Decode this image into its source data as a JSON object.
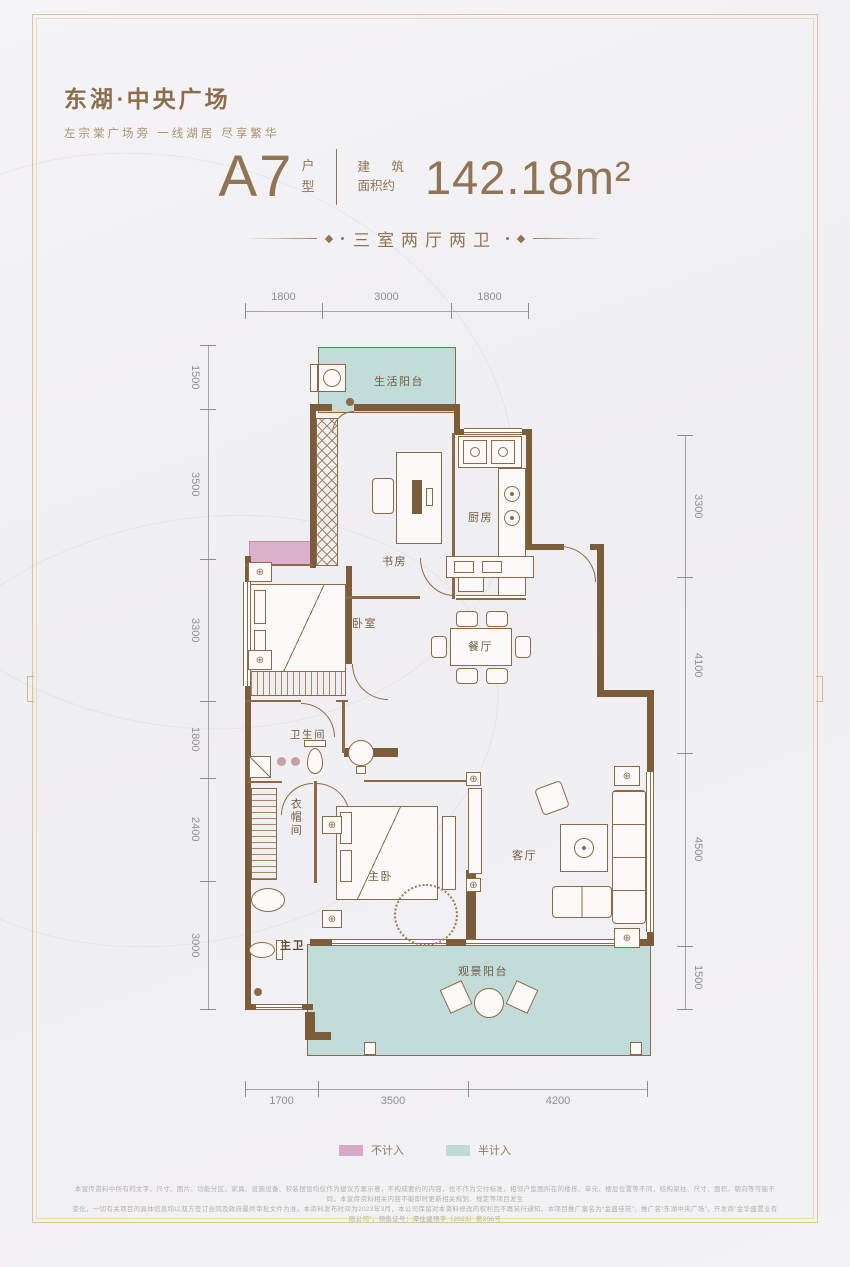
{
  "brand": {
    "logo": "东湖·中央广场",
    "tagline": "左宗棠广场旁 一线湖居 尽享繁华"
  },
  "unit": {
    "name": "A7",
    "type_label": "户型",
    "area_label_line1": "建 筑",
    "area_label_line2": "面积约",
    "area_value": "142.18m²",
    "layout": "三室两厅两卫"
  },
  "plan": {
    "rooms": {
      "service_balcony": "生活阳台",
      "study": "书房",
      "kitchen": "厨房",
      "bedroom": "卧室",
      "dining": "餐厅",
      "bathroom": "卫生间",
      "cloakroom": "衣帽间",
      "master_bedroom": "主卧",
      "living_room": "客厅",
      "master_bath": "主卫",
      "view_balcony": "观景阳台"
    },
    "dims": {
      "top": [
        "1800",
        "3000",
        "1800"
      ],
      "left": [
        "1500",
        "3500",
        "3300",
        "1800",
        "2400",
        "3000"
      ],
      "right": [
        "3300",
        "4100",
        "4500",
        "1500"
      ],
      "bottom": [
        "1700",
        "3500",
        "4200"
      ]
    }
  },
  "legend": {
    "items": [
      {
        "label": "不计入",
        "color": "#d8a9c6"
      },
      {
        "label": "半计入",
        "color": "#bedbd8"
      }
    ]
  },
  "icons": {
    "fixture_cross": "⊕"
  },
  "colors": {
    "accent_bronze": "#8f7456",
    "wall_brown": "#7b5c3b",
    "teal": "#c2dcd9",
    "pink": "#dcb0cb"
  },
  "disclaimer": {
    "line1": "本宣传资料中所有的文字、尺寸、图片、功能分区、家具、设施设备、软装摆设均仅作为建议方案示意，不构成要约的内容，也不作为交付标准，相邻户型图所在的楼栋、单元、楼层位置等不同，结构梁柱、尺寸、面积、朝向等可能不同，本宣传资料相关内容不能即时更新相关规划、规定等项目发生",
    "line2": "变化，一切有关项目的具体信息均以双方签订合同及政府最终审批文件为准。本资料发布时间为2023年3月，本公司保留对本资料修改的权利且不再另行通知。本项目推广案名为“金盛佳苑”，推广名“东湖中央广场”，开发商“金华盛置业有限公司”，预售证号：潭住建预字（2023）第206号"
  }
}
